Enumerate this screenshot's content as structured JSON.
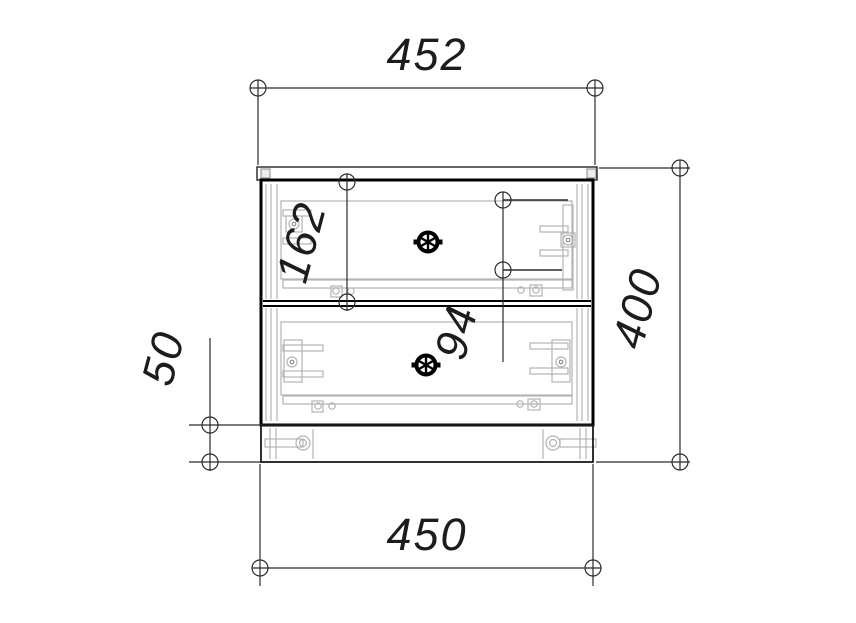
{
  "meta": {
    "type": "furniture technical drawing",
    "view": "front elevation of two-drawer cabinet with plinth"
  },
  "dimensions": {
    "top_width": "452",
    "bottom_width": "450",
    "overall_height": "400",
    "plinth_height": "50",
    "top_drawer_height": "162",
    "slide_offset": "94"
  },
  "colors": {
    "background": "#ffffff",
    "outline": "#0d0d0d",
    "dimension_line": "#2b2b2b",
    "hidden_detail": "#b3b3b3"
  }
}
